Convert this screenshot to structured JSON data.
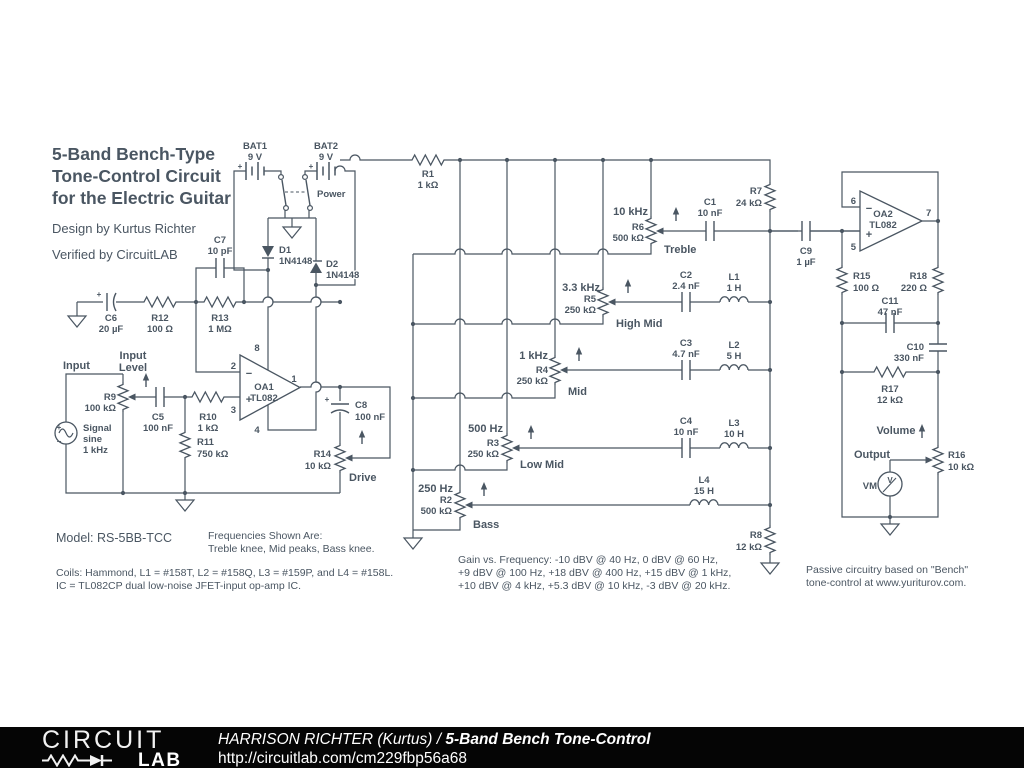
{
  "schematic": {
    "title1": "5-Band Bench-Type",
    "title2": "Tone-Control Circuit",
    "title3": "for the Electric Guitar",
    "design": "Design by Kurtus Richter",
    "verified": "Verified by CircuitLAB"
  },
  "power": {
    "bat1": "BAT1",
    "bat1v": "9 V",
    "bat2": "BAT2",
    "bat2v": "9 V",
    "plus": "+",
    "switch": "Power",
    "d1": "D1",
    "d1v": "1N4148",
    "d2": "D2",
    "d2v": "1N4148"
  },
  "input": {
    "label": "Input",
    "level1": "Input",
    "level2": "Level",
    "src1": "Signal",
    "src2": "sine",
    "src3": "1 kHz",
    "srcplus": "+",
    "srcminus": "−",
    "c6": "C6",
    "c6v": "20 µF",
    "c6plus": "+",
    "r12": "R12",
    "r12v": "100 Ω",
    "r13": "R13",
    "r13v": "1 MΩ",
    "c7": "C7",
    "c7v": "10 pF",
    "r9": "R9",
    "r9v": "100 kΩ",
    "c5": "C5",
    "c5v": "100 nF",
    "r10": "R10",
    "r10v": "1 kΩ",
    "r11": "R11",
    "r11v": "750 kΩ"
  },
  "oa1": {
    "name": "OA1",
    "part": "TL082",
    "p1": "1",
    "p2": "2",
    "p3": "3",
    "p4": "4",
    "p8": "8",
    "minus": "−",
    "plus": "+"
  },
  "drive": {
    "c8": "C8",
    "c8v": "100 nF",
    "plus": "+",
    "r14": "R14",
    "r14v": "10 kΩ",
    "label": "Drive"
  },
  "matrix": {
    "r1": "R1",
    "r1v": "1 kΩ",
    "r7": "R7",
    "r7v": "24 kΩ",
    "r8": "R8",
    "r8v": "12 kΩ"
  },
  "bands": {
    "treble": {
      "freq": "10 kHz",
      "ref": "R6",
      "val": "500 kΩ",
      "name": "Treble"
    },
    "highmid": {
      "freq": "3.3 kHz",
      "ref": "R5",
      "val": "250 kΩ",
      "name": "High Mid"
    },
    "mid": {
      "freq": "1 kHz",
      "ref": "R4",
      "val": "250 kΩ",
      "name": "Mid"
    },
    "lowmid": {
      "freq": "500 Hz",
      "ref": "R3",
      "val": "250 kΩ",
      "name": "Low Mid"
    },
    "bass": {
      "freq": "250 Hz",
      "ref": "R2",
      "val": "500 kΩ",
      "name": "Bass"
    }
  },
  "filters": {
    "c1": "C1",
    "c1v": "10 nF",
    "c2": "C2",
    "c2v": "2.4 nF",
    "c3": "C3",
    "c3v": "4.7 nF",
    "c4": "C4",
    "c4v": "10 nF",
    "l1": "L1",
    "l1v": "1 H",
    "l2": "L2",
    "l2v": "5 H",
    "l3": "L3",
    "l3v": "10 H",
    "l4": "L4",
    "l4v": "15 H"
  },
  "out": {
    "c9": "C9",
    "c9v": "1 µF",
    "oa2": "OA2",
    "part": "TL082",
    "p5": "5",
    "p6": "6",
    "p7": "7",
    "minus": "−",
    "plus": "+",
    "r15": "R15",
    "r15v": "100 Ω",
    "r18": "R18",
    "r18v": "220 Ω",
    "c11": "C11",
    "c11v": "47 nF",
    "c10": "C10",
    "c10v": "330 nF",
    "r17": "R17",
    "r17v": "12 kΩ",
    "r16": "R16",
    "r16v": "10 kΩ",
    "volume": "Volume",
    "output": "Output",
    "vm": "VM",
    "v": "V"
  },
  "notes": {
    "model": "Model: RS-5BB-TCC",
    "freq1": "Frequencies Shown Are:",
    "freq2": "Treble knee, Mid peaks, Bass knee.",
    "coils": "Coils: Hammond, L1 = #158T, L2 = #158Q, L3 = #159P, and L4 = #158L.",
    "ic": "IC = TL082CP dual low-noise JFET-input op-amp IC.",
    "gain1": "Gain vs. Frequency: -10 dBV @ 40 Hz, 0 dBV @ 60 Hz,",
    "gain2": "+9 dBV @ 100 Hz, +18 dBV @ 400 Hz, +15 dBV @ 1 kHz,",
    "gain3": "+10 dBV @ 4 kHz, +5.3 dBV @ 10 kHz, -3 dBV @ 20 kHz.",
    "passive1": "Passive circuitry based on \"Bench\"",
    "passive2": "tone-control at www.yuriturov.com."
  },
  "footer": {
    "brand1": "CIRCUIT",
    "brand2": "LAB",
    "author": "HARRISON RICHTER (Kurtus)",
    "sep": " / ",
    "title": "5-Band Bench Tone-Control",
    "url": "http://circuitlab.com/cm229fbp56a68"
  },
  "colors": {
    "ink": "#4a5662",
    "footer_bg": "#050505",
    "footer_text": "#ffffff"
  }
}
